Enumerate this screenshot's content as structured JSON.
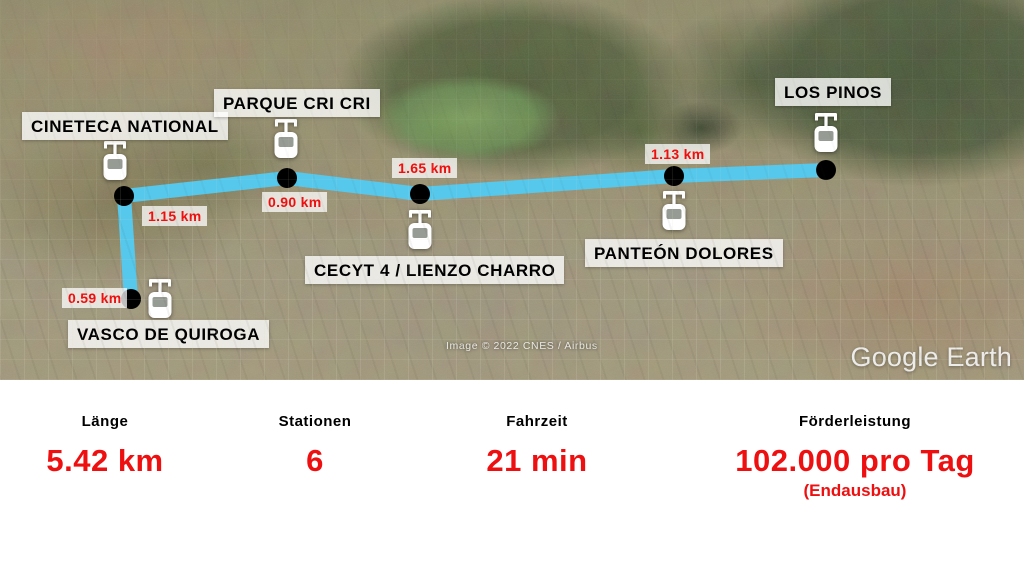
{
  "map": {
    "attribution": "Image © 2022 CNES / Airbus",
    "watermark": "Google Earth"
  },
  "route": {
    "color": "#55c8ec",
    "station_dot_color": "#000000",
    "distance_text_color": "#f20d0d",
    "stations": [
      {
        "name": "VASCO DE QUIROGA"
      },
      {
        "name": "CINETECA NATIONAL"
      },
      {
        "name": "PARQUE CRI CRI"
      },
      {
        "name": "CECYT 4 / LIENZO CHARRO"
      },
      {
        "name": "PANTEÓN DOLORES"
      },
      {
        "name": "LOS PINOS"
      }
    ],
    "segment_distances": [
      {
        "label": "0.59 km"
      },
      {
        "label": "1.15 km"
      },
      {
        "label": "0.90 km"
      },
      {
        "label": "1.65 km"
      },
      {
        "label": "1.13 km"
      }
    ]
  },
  "stats": {
    "accent_color": "#ee1010",
    "items": [
      {
        "label": "Länge",
        "value": "5.42 km"
      },
      {
        "label": "Stationen",
        "value": "6"
      },
      {
        "label": "Fahrzeit",
        "value": "21 min"
      },
      {
        "label": "Förderleistung",
        "value": "102.000 pro Tag",
        "note": "(Endausbau)"
      }
    ]
  }
}
